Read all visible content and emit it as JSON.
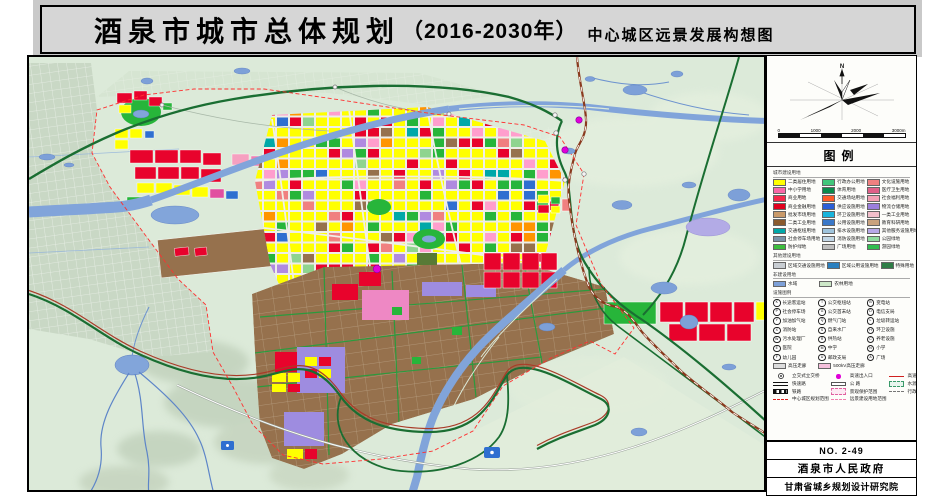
{
  "title": {
    "main": "酒泉市城市总体规划",
    "paren": "（2016-2030年）",
    "subtitle": "中心城区远景发展构想图"
  },
  "panel": {
    "compass_label": "N",
    "scale_ticks": [
      "0",
      "1000",
      "2000",
      "3000m"
    ],
    "legend_title": "图例",
    "sections": {
      "landuse": {
        "header": "城市建设用地",
        "items": [
          {
            "c": "#ffff00",
            "t": "二类居住用地"
          },
          {
            "c": "#41c67b",
            "t": "行政办公用地"
          },
          {
            "c": "#f08080",
            "t": "文化设施用地"
          },
          {
            "c": "#f868a8",
            "t": "中小学用地"
          },
          {
            "c": "#0a8a4b",
            "t": "体育用地"
          },
          {
            "c": "#e06088",
            "t": "医疗卫生用地"
          },
          {
            "c": "#f5284b",
            "t": "商业用地"
          },
          {
            "c": "#ff5a28",
            "t": "交通场站用地"
          },
          {
            "c": "#f4a0b4",
            "t": "社会福利用地"
          },
          {
            "c": "#e1001e",
            "t": "商业金融用地"
          },
          {
            "c": "#2b5fd7",
            "t": "供应设施用地"
          },
          {
            "c": "#9b7edc",
            "t": "物流仓储用地"
          },
          {
            "c": "#c99a6a",
            "t": "批发市场用地"
          },
          {
            "c": "#19b4dc",
            "t": "环卫设施用地"
          },
          {
            "c": "#f2bfcb",
            "t": "一类工业用地"
          },
          {
            "c": "#8a5a2d",
            "t": "二类工业用地"
          },
          {
            "c": "#3a78c8",
            "t": "公用设施用地"
          },
          {
            "c": "#c9a27e",
            "t": "教育科研用地"
          },
          {
            "c": "#00a8a8",
            "t": "交通枢纽用地"
          },
          {
            "c": "#9fc4dc",
            "t": "排水设施用地"
          },
          {
            "c": "#b7a8e8",
            "t": "其他服务设施用地"
          },
          {
            "c": "#7a93a8",
            "t": "社会停车场用地"
          },
          {
            "c": "#c3d7e6",
            "t": "消防设施用地"
          },
          {
            "c": "#8fdc9f",
            "t": "公园绿地"
          },
          {
            "c": "#3dbe3d",
            "t": "防护绿地"
          },
          {
            "c": "#bfbfbf",
            "t": "广场用地"
          },
          {
            "c": "#2fbe4f",
            "t": "游园绿地"
          }
        ]
      },
      "other": {
        "header": "其他建设用地",
        "items": [
          {
            "c": "#c8cdd2",
            "t": "区域交通设施用地"
          },
          {
            "c": "#2a7fbe",
            "t": "区域公用设施用地"
          },
          {
            "c": "#2e7d46",
            "t": "特殊用地"
          }
        ]
      },
      "noncon": {
        "header": "非建设用地",
        "items": [
          {
            "c": "#7da0d8",
            "t": "水域"
          },
          {
            "c": "#cde8c8",
            "t": "农林用地"
          }
        ]
      },
      "facility": {
        "header": "设施图例",
        "items": [
          {
            "g": "K",
            "t": "长途客运站"
          },
          {
            "g": "T",
            "t": "公交枢纽站"
          },
          {
            "g": "B",
            "t": "变电站"
          },
          {
            "g": "P",
            "t": "社会停车场"
          },
          {
            "g": "G",
            "t": "公交首末站"
          },
          {
            "g": "D",
            "t": "电信支局"
          },
          {
            "g": "Y",
            "t": "加油加气站"
          },
          {
            "g": "Q",
            "t": "燃气门站"
          },
          {
            "g": "L",
            "t": "垃圾转运站"
          },
          {
            "g": "X",
            "t": "消防站"
          },
          {
            "g": "S",
            "t": "自来水厂"
          },
          {
            "g": "H",
            "t": "环卫设施"
          },
          {
            "g": "W",
            "t": "污水处理厂"
          },
          {
            "g": "R",
            "t": "供热站"
          },
          {
            "g": "C",
            "t": "养老设施"
          },
          {
            "g": "E",
            "t": "医院"
          },
          {
            "g": "M",
            "t": "中学"
          },
          {
            "g": "N",
            "t": "小学"
          },
          {
            "g": "F",
            "t": "幼儿园"
          },
          {
            "g": "U",
            "t": "邮政支局"
          },
          {
            "g": "A",
            "t": "广场"
          },
          {
            "s": "#dcdcdc",
            "t": "高压走廊"
          },
          {
            "s": "#f5c0dc",
            "t": "500kV高压走廊"
          },
          {
            "g": "",
            "t": ""
          }
        ]
      },
      "lines": {
        "items": [
          {
            "k": "interchange",
            "t": "立交式立交桥"
          },
          {
            "k": "exit",
            "t": "高速出入口"
          },
          {
            "k": "expressway",
            "t": "高速公路"
          },
          {
            "k": "arterial",
            "t": "快速路"
          },
          {
            "k": "road",
            "t": "公 路"
          },
          {
            "k": "waterprot",
            "t": "水源地一级保护区"
          },
          {
            "k": "rail",
            "t": "铁路"
          },
          {
            "k": "scenic",
            "t": "景观保护范围"
          },
          {
            "k": "admin",
            "t": "行政区划界线"
          },
          {
            "k": "cityline",
            "t": "中心城区规划范围"
          },
          {
            "k": "futureline",
            "t": "远景建设用地范围"
          }
        ]
      }
    },
    "boxes": {
      "no": "NO. 2-49",
      "gov": "酒泉市人民政府",
      "institute": "甘肃省城乡规划设计研究院"
    }
  },
  "map": {
    "colors": {
      "background": "#dcead9",
      "river": "#81a4da",
      "road_green": "#1a6e32",
      "railway": "#8a3a1e",
      "boundary": "#ff3030",
      "industrial": "#96714d"
    }
  }
}
